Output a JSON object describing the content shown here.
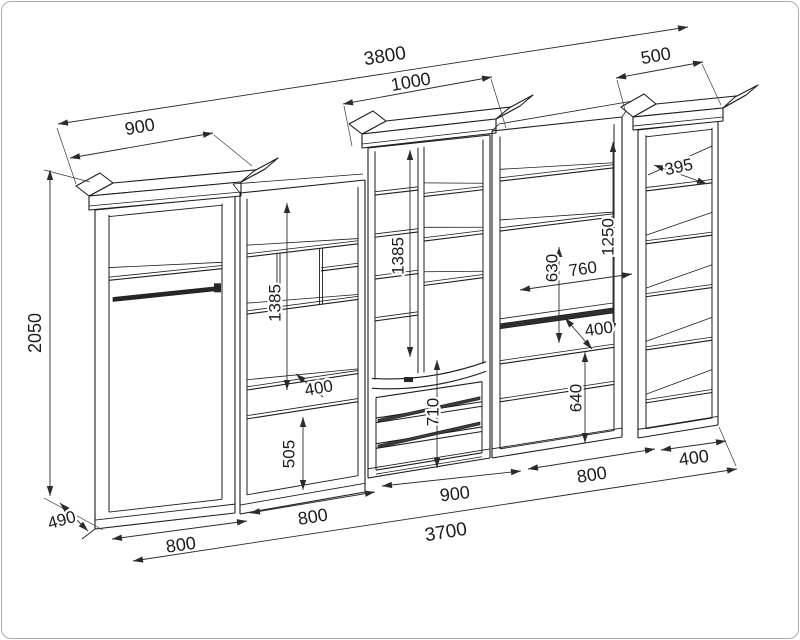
{
  "canvas": {
    "background": "#ffffff",
    "border_color": "#ababab",
    "line_color": "#1d1d1d",
    "dim_line_color": "#2b2b2b",
    "dark_fill": "#2e2e2e",
    "text_color": "#1c1c1c"
  },
  "drawing": {
    "kind": "furniture-wall-unit-dimension-drawing",
    "units": [
      {
        "id": "wardrobe"
      },
      {
        "id": "shelf-section"
      },
      {
        "id": "display-cabinet"
      },
      {
        "id": "tv-section"
      },
      {
        "id": "bookcase"
      }
    ]
  },
  "dimensions_mm": [
    {
      "id": "overall-top-width",
      "value": "3800",
      "line": [
        58,
        124,
        688,
        27
      ],
      "label": [
        385,
        57
      ],
      "rot": -9,
      "size": 19
    },
    {
      "id": "bookcase-top-width",
      "value": "500",
      "line": [
        616,
        78,
        703,
        62
      ],
      "label": [
        656,
        57
      ],
      "rot": -10,
      "size": 18
    },
    {
      "id": "display-top-width",
      "value": "1000",
      "line": [
        343,
        104,
        492,
        77
      ],
      "label": [
        411,
        83
      ],
      "rot": -10,
      "size": 18
    },
    {
      "id": "wardrobe-top-width",
      "value": "900",
      "line": [
        70,
        158,
        213,
        133
      ],
      "label": [
        140,
        128
      ],
      "rot": -10,
      "size": 18
    },
    {
      "id": "wardrobe-height",
      "value": "2050",
      "line": [
        50,
        170,
        50,
        496
      ],
      "label": [
        36,
        333
      ],
      "rot": -90,
      "size": 18
    },
    {
      "id": "wardrobe-depth",
      "value": "490",
      "line": [
        60,
        503,
        88,
        531
      ],
      "label": [
        62,
        521
      ],
      "rot": -16,
      "size": 17
    },
    {
      "id": "wardrobe-bottom-width",
      "value": "800",
      "line": [
        112,
        539,
        247,
        521
      ],
      "label": [
        181,
        546
      ],
      "rot": -8,
      "size": 18
    },
    {
      "id": "shelf-bottom-width",
      "value": "800",
      "line": [
        250,
        513,
        375,
        492
      ],
      "label": [
        313,
        518
      ],
      "rot": -9,
      "size": 18
    },
    {
      "id": "display-bottom-width",
      "value": "900",
      "line": [
        382,
        486,
        521,
        471
      ],
      "label": [
        455,
        495
      ],
      "rot": -7,
      "size": 18
    },
    {
      "id": "tv-bottom-width",
      "value": "800",
      "line": [
        528,
        469,
        655,
        449
      ],
      "label": [
        592,
        476
      ],
      "rot": -9,
      "size": 18
    },
    {
      "id": "bookcase-bottom-width",
      "value": "400",
      "line": [
        661,
        450,
        726,
        441
      ],
      "label": [
        694,
        459
      ],
      "rot": -8,
      "size": 18
    },
    {
      "id": "overall-bottom-width",
      "value": "3700",
      "line": [
        133,
        561,
        737,
        469
      ],
      "label": [
        446,
        533
      ],
      "rot": -9,
      "size": 19
    },
    {
      "id": "shelf-upper-height",
      "value": "1385",
      "line": [
        287,
        203,
        287,
        390
      ],
      "label": [
        276,
        303
      ],
      "rot": -90,
      "size": 17
    },
    {
      "id": "shelf-niche-depth",
      "value": "400",
      "line": [
        296,
        374,
        323,
        397
      ],
      "label": [
        319,
        389
      ],
      "rot": -10,
      "size": 17
    },
    {
      "id": "shelf-lower-height",
      "value": "505",
      "line": [
        303,
        417,
        303,
        490
      ],
      "label": [
        290,
        454
      ],
      "rot": -90,
      "size": 17
    },
    {
      "id": "display-glass-height",
      "value": "1385",
      "line": [
        410,
        150,
        410,
        357
      ],
      "label": [
        399,
        256
      ],
      "rot": -90,
      "size": 17
    },
    {
      "id": "drawers-height",
      "value": "710",
      "line": [
        437,
        360,
        437,
        468
      ],
      "label": [
        434,
        412
      ],
      "rot": -90,
      "size": 17
    },
    {
      "id": "tv-upper-height",
      "value": "1250",
      "line": [
        613,
        142,
        613,
        333
      ],
      "label": [
        609,
        237
      ],
      "rot": -90,
      "size": 17
    },
    {
      "id": "tv-niche-height",
      "value": "630",
      "line": [
        559,
        247,
        559,
        343
      ],
      "label": [
        553,
        268
      ],
      "rot": -90,
      "size": 17
    },
    {
      "id": "tv-niche-width",
      "value": "760",
      "line": [
        520,
        290,
        632,
        274
      ],
      "label": [
        583,
        270
      ],
      "rot": -8,
      "size": 17
    },
    {
      "id": "tv-shelf-depth",
      "value": "400",
      "line": [
        565,
        318,
        592,
        349
      ],
      "label": [
        599,
        330
      ],
      "rot": -8,
      "size": 17
    },
    {
      "id": "tv-lower-height",
      "value": "640",
      "line": [
        585,
        352,
        585,
        443
      ],
      "label": [
        577,
        398
      ],
      "rot": -90,
      "size": 17
    },
    {
      "id": "bookcase-shelf-depth",
      "value": "395",
      "line": [
        654,
        165,
        707,
        184
      ],
      "label": [
        679,
        168
      ],
      "rot": -12,
      "size": 17
    }
  ]
}
